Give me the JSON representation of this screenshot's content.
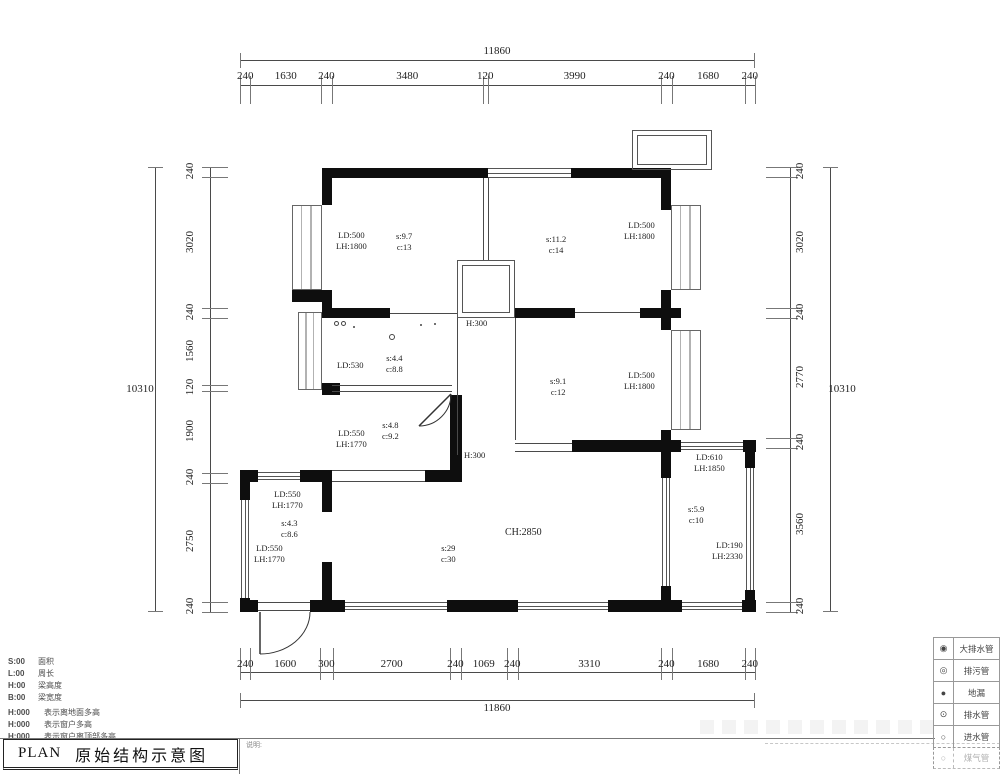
{
  "dims": {
    "top": {
      "total": "11860",
      "segments": [
        240,
        1630,
        240,
        3480,
        120,
        3990,
        240,
        1680,
        240
      ]
    },
    "bottom": {
      "total": "11860",
      "segments": [
        240,
        1600,
        300,
        2700,
        240,
        1069,
        240,
        3310,
        240,
        1680,
        240
      ]
    },
    "left": {
      "total": "10310",
      "segments": [
        240,
        3020,
        240,
        1560,
        120,
        1900,
        240,
        2750,
        240
      ]
    },
    "right": {
      "total": "10310",
      "segments": [
        240,
        3020,
        240,
        2770,
        240,
        3560,
        240
      ]
    }
  },
  "plan": {
    "rooms": {
      "bed1": {
        "ld": "LD:500",
        "lh": "LH:1800",
        "s": "s:9.7",
        "c": "c:13"
      },
      "bed2": {
        "s": "s:11.2",
        "c": "c:14",
        "ld": "LD:500",
        "lh": "LH:1800"
      },
      "kitchen": {
        "ld": "LD:530",
        "s": "s:4.4",
        "c": "c:8.8"
      },
      "bed3": {
        "s": "s:9.1",
        "c": "c:12",
        "ld": "LD:500",
        "lh": "LH:1800"
      },
      "bath": {
        "s": "s:4.8",
        "c": "c:9.2",
        "ld": "LD:550",
        "lh": "LH:1770"
      },
      "porch": {
        "top_ld": "LD:550",
        "top_lh": "LH:1770",
        "s": "s:4.3",
        "c": "c:8.6",
        "left_ld": "LD:550",
        "left_lh": "LH:1770"
      },
      "living": {
        "ch": "CH:2850",
        "s": "s:29",
        "c": "c:30"
      },
      "balcony": {
        "top_ld": "LD:610",
        "top_lh": "LH:1850",
        "s": "s:5.9",
        "c": "c:10",
        "right_ld": "LD:190",
        "right_lh": "LH:2330"
      },
      "beam1": "H:300",
      "beam2": "H:300"
    }
  },
  "legend_codes": [
    {
      "code": "S:00",
      "label": "面积"
    },
    {
      "code": "L:00",
      "label": "周长"
    },
    {
      "code": "H:00",
      "label": "梁高度"
    },
    {
      "code": "B:00",
      "label": "梁宽度"
    }
  ],
  "legend_notes": [
    {
      "code": "H:000",
      "label": "表示离地面多高"
    },
    {
      "code": "H:000",
      "label": "表示窗户多高"
    },
    {
      "code": "H:000",
      "label": "表示窗户离顶部多高"
    }
  ],
  "symbol_table": [
    {
      "symbol": "◉",
      "label": "大排水管"
    },
    {
      "symbol": "◎",
      "label": "排污管"
    },
    {
      "symbol": "●",
      "label": "地漏"
    },
    {
      "symbol": "⊙",
      "label": "排水管"
    },
    {
      "symbol": "○",
      "label": "进水管"
    },
    {
      "symbol": "○",
      "label": "煤气管"
    }
  ],
  "title_block": {
    "plan": "PLAN",
    "title": "原始结构示意图",
    "note_label": "说明:"
  },
  "colors": {
    "wall": "#0e0e0e",
    "line": "#4a4a4a",
    "text": "#222222"
  }
}
